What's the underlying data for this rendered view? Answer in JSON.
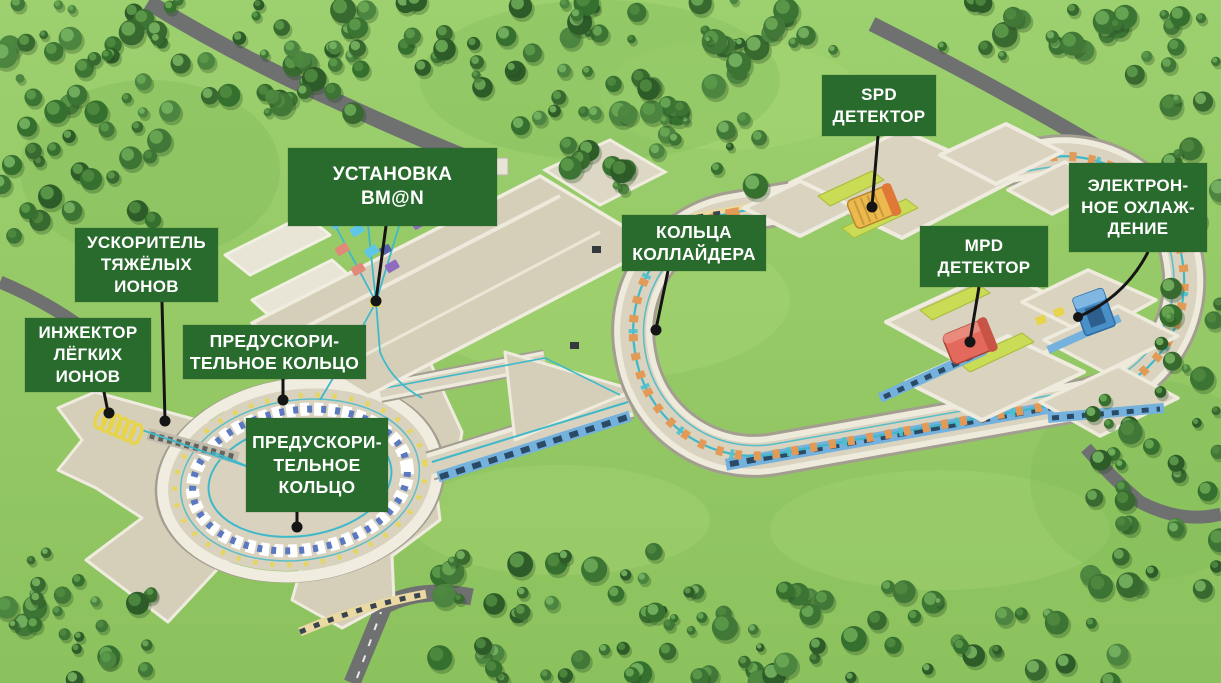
{
  "scene": {
    "kind": "aerial-3d-render",
    "subject": "particle accelerator complex with annotated facilities"
  },
  "labels": [
    {
      "id": "bmn-facility",
      "text": "УСТАНОВКА\nBM@N"
    },
    {
      "id": "spd-detector",
      "text": "SPD\nДЕТЕКТОР"
    },
    {
      "id": "electron-cooling",
      "text": "ЭЛЕКТРОН-\nНОЕ ОХЛАЖ-\nДЕНИЕ"
    },
    {
      "id": "collider-rings",
      "text": "КОЛЬЦА\nКОЛЛАЙДЕРА"
    },
    {
      "id": "mpd-detector",
      "text": "MPD\nДЕТЕКТОР"
    },
    {
      "id": "heavy-ion-accelerator",
      "text": "УСКОРИТЕЛЬ\nТЯЖЁЛЫХ\nИОНОВ"
    },
    {
      "id": "light-ion-injector",
      "text": "ИНЖЕКТОР\nЛЁГКИХ\nИОНОВ"
    },
    {
      "id": "booster-ring-a",
      "text": "ПРЕДУСКОРИ-\nТЕЛЬНОЕ КОЛЬЦО"
    },
    {
      "id": "booster-ring-b",
      "text": "ПРЕДУСКОРИ-\nТЕЛЬНОЕ\nКОЛЬЦО"
    }
  ],
  "colors": {
    "label_bg": "#286b2d",
    "label_text": "#ffffff",
    "grass": "#97cb66",
    "road": "#6f7070",
    "building_wall": "#eeebdd",
    "building_floor": "#d8d2be",
    "wall_shadow": "#a39e8f",
    "beam_line": "#3fb9c9",
    "collider_magnet": "#e39a56",
    "booster_magnet_blue": "#5b79c0",
    "spd_detector": "#ecb94e",
    "spd_detector_cap": "#e07838",
    "mpd_detector": "#e2695b",
    "electron_cooling_unit": "#4a90c8",
    "lime_wall": "#cadb55",
    "blue_wall": "#74b1dc",
    "window_dark": "#2a4a66",
    "cream_wall": "#ead9a2",
    "injector_coil": "#e8d44a",
    "pointer": "#151515"
  }
}
